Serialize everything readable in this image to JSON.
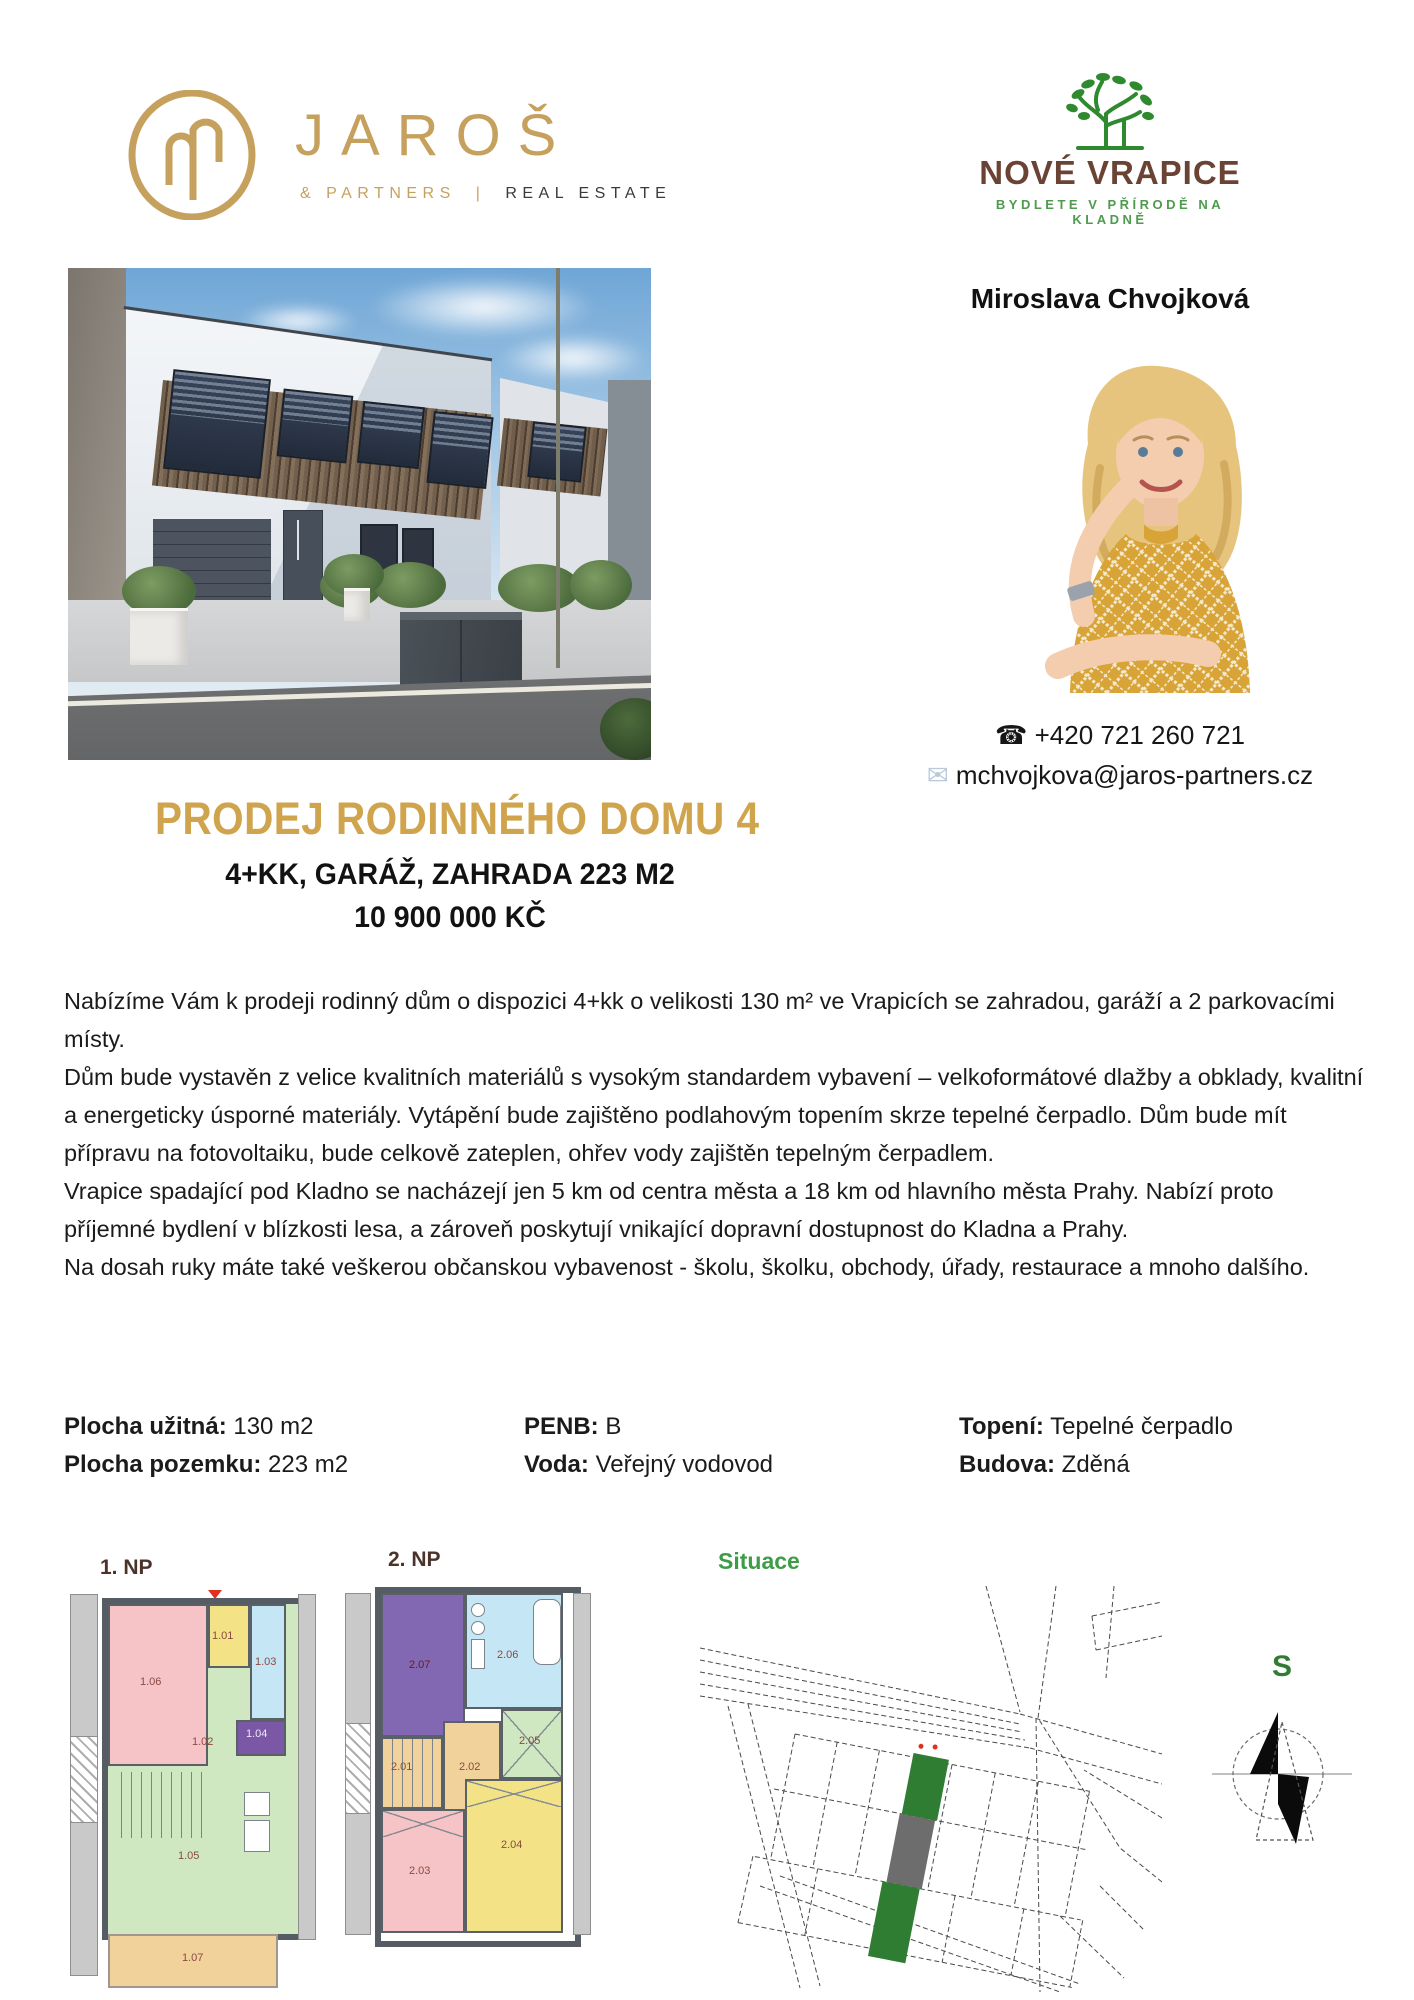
{
  "header": {
    "jaros": {
      "name": "JAROŠ",
      "sub_left": "& PARTNERS",
      "divider": "|",
      "sub_right": "REAL ESTATE"
    },
    "vrapice": {
      "name": "NOVÉ VRAPICE",
      "tagline": "BYDLETE V PŘÍRODĚ NA KLADNĚ"
    }
  },
  "agent": {
    "name": "Miroslava Chvojková",
    "phone_icon": "☎",
    "phone": "+420 721 260 721",
    "email_icon": "✉",
    "email": "mchvojkova@jaros-partners.cz"
  },
  "listing": {
    "title": "PRODEJ RODINNÉHO DOMU 4",
    "subtitle": "4+KK, GARÁŽ, ZAHRADA 223 M2",
    "price": "10 900 000 KČ"
  },
  "description": {
    "paragraphs": [
      "Nabízíme Vám k prodeji rodinný dům o dispozici 4+kk o velikosti 130 m² ve Vrapicích se zahradou, garáží a 2 parkovacími místy.",
      "Dům bude vystavěn z velice kvalitních materiálů s vysokým standardem vybavení – velkoformátové dlažby a obklady, kvalitní a energeticky úsporné materiály. Vytápění bude zajištěno podlahovým topením skrze tepelné čerpadlo. Dům bude mít přípravu na fotovoltaiku, bude celkově zateplen, ohřev vody zajištěn tepelným čerpadlem.",
      "Vrapice spadající pod Kladno se nacházejí jen 5 km od centra města a 18 km od hlavního města Prahy. Nabízí proto příjemné bydlení v blízkosti lesa, a zároveň poskytují vnikající dopravní dostupnost do Kladna a Prahy.",
      "Na dosah ruky máte také veškerou občanskou vybavenost - školu, školku, obchody, úřady, restaurace a mnoho dalšího."
    ]
  },
  "details": {
    "rows": [
      [
        {
          "label": "Plocha užitná:",
          "value": "130 m2"
        },
        {
          "label": "PENB:",
          "value": "B"
        },
        {
          "label": "Topení:",
          "value": "Tepelné čerpadlo"
        }
      ],
      [
        {
          "label": "Plocha pozemku:",
          "value": "223 m2"
        },
        {
          "label": "Voda:",
          "value": "Veřejný vodovod"
        },
        {
          "label": "Budova:",
          "value": "Zděná"
        }
      ]
    ]
  },
  "plans": {
    "np1": {
      "label": "1. NP",
      "rooms": [
        "1.01",
        "1.02",
        "1.03",
        "1.04",
        "1.05",
        "1.06",
        "1.07"
      ]
    },
    "np2": {
      "label": "2. NP",
      "rooms": [
        "2.01",
        "2.02",
        "2.03",
        "2.04",
        "2.05",
        "2.06",
        "2.07"
      ]
    },
    "site": {
      "label": "Situace"
    },
    "compass": {
      "north": "S"
    }
  },
  "palette": {
    "gold": "#C6A15E",
    "title_gold": "#CFA44C",
    "logo_brown": "#6B4335",
    "logo_green": "#3D8B37",
    "situace_green": "#3E9C47",
    "plot_green": "#2E7D32",
    "plot_gray": "#6D6D6D"
  }
}
